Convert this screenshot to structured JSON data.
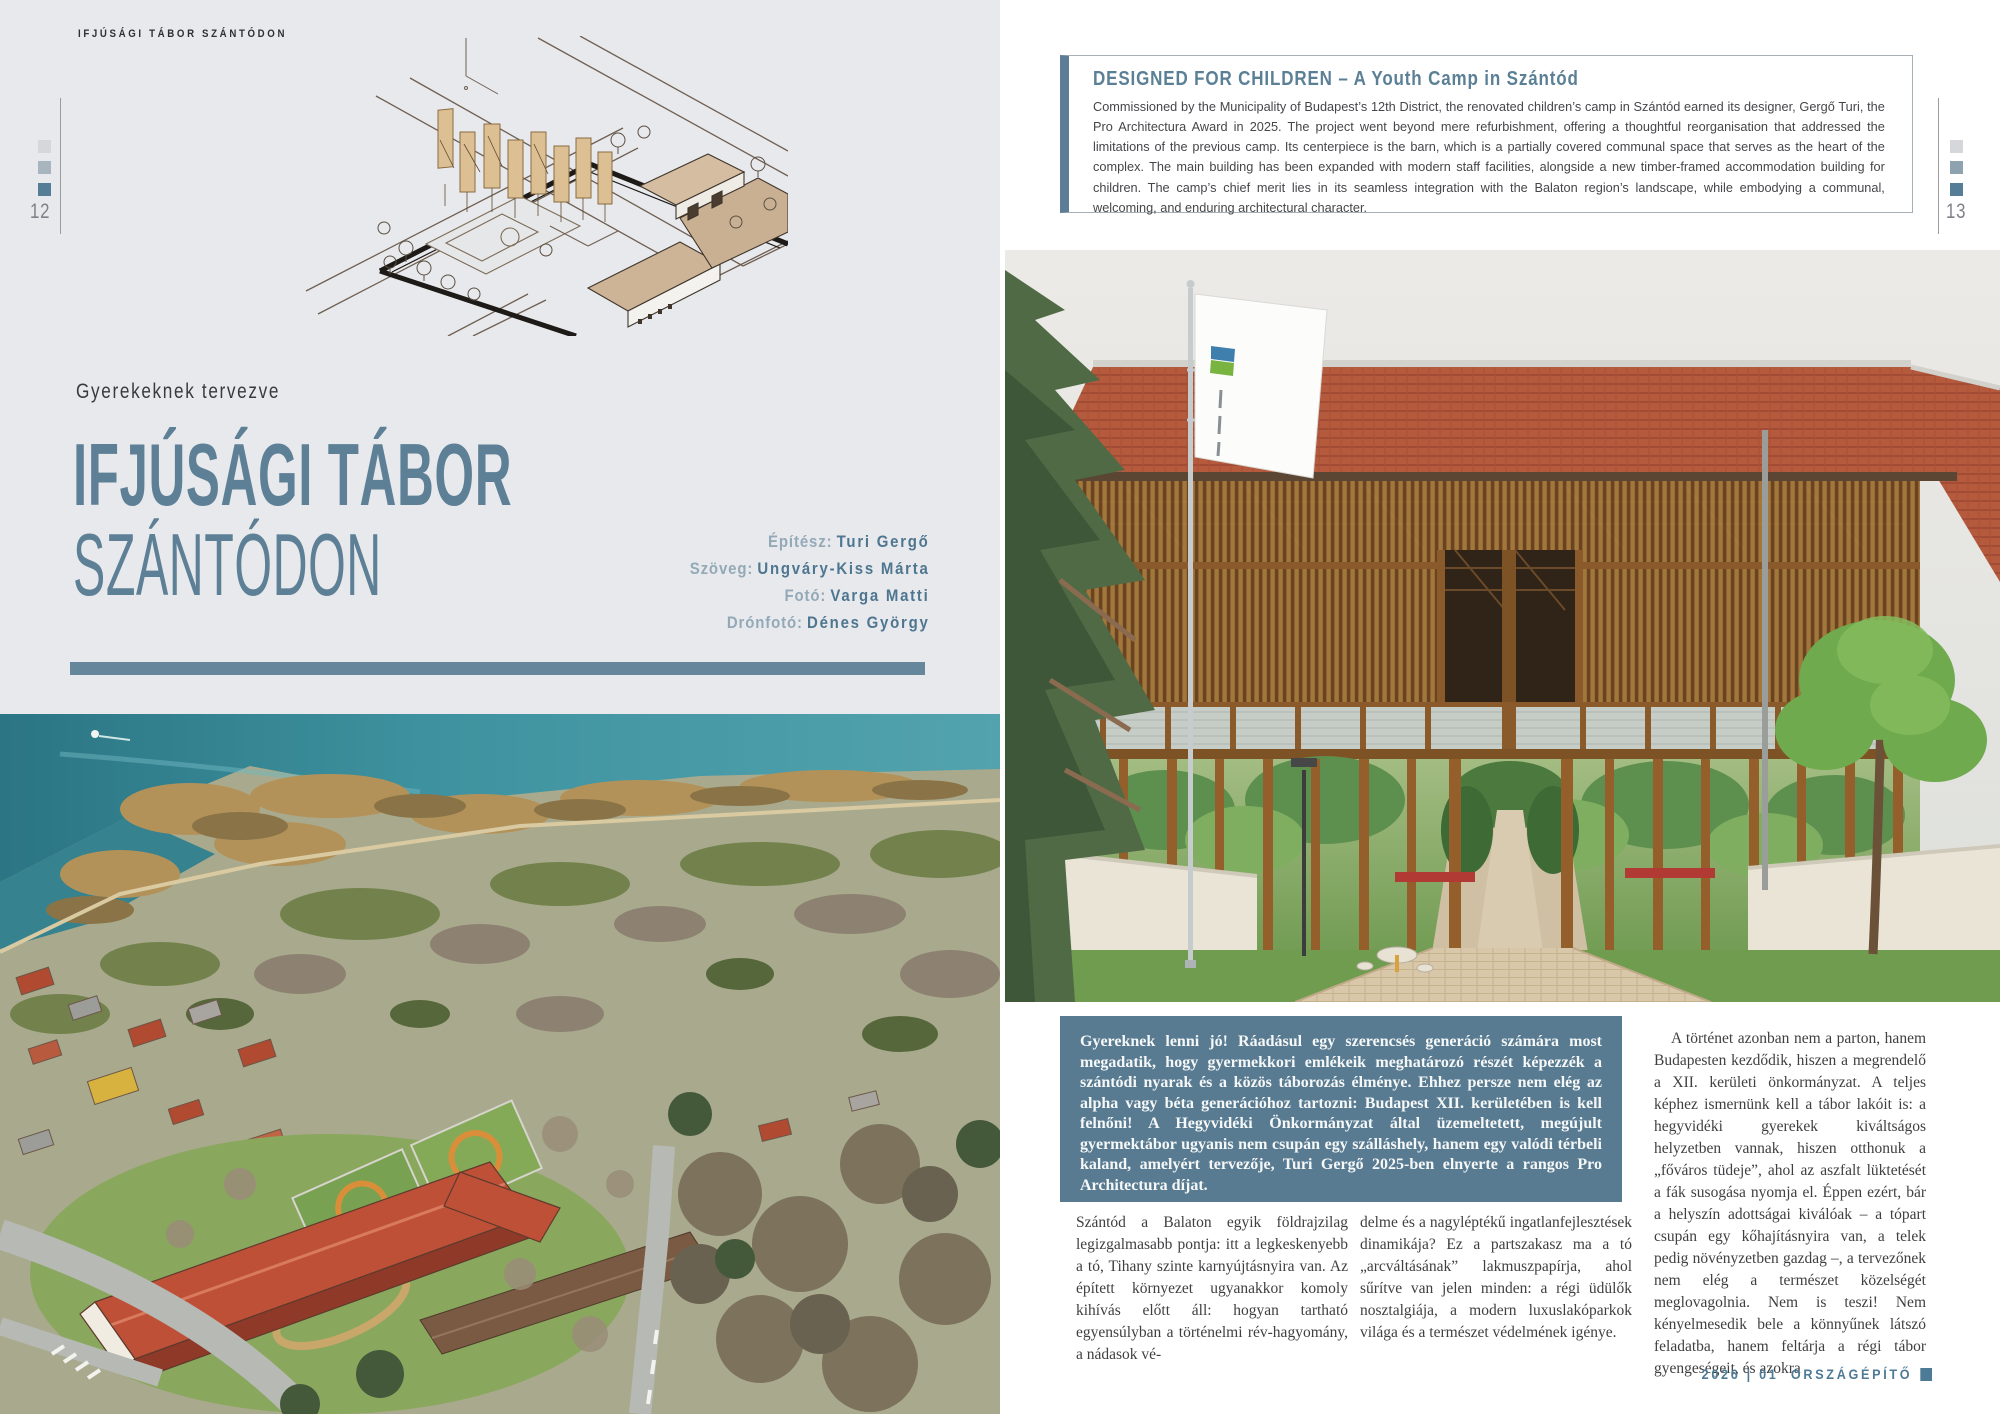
{
  "colors": {
    "accent_slate": "#5e8096",
    "lead_box_background": "#587b92",
    "left_page_background": "#e8e9ec",
    "footer_blue": "#4d7a96"
  },
  "page_left": {
    "running_header": "IFJÚSÁGI TÁBOR SZÁNTÓDON",
    "page_number": "12",
    "kicker": "Gyerekeknek tervezve",
    "title_line1": "IFJÚSÁGI TÁBOR",
    "title_line2": "SZÁNTÓDON",
    "credits": [
      {
        "label": "Építész:",
        "name": "Turi Gergő"
      },
      {
        "label": "Szöveg:",
        "name": "Ungváry-Kiss Márta"
      },
      {
        "label": "Fotó:",
        "name": "Varga Matti"
      },
      {
        "label": "Drónfotó:",
        "name": "Dénes György"
      }
    ]
  },
  "page_right": {
    "page_number": "13",
    "intro": {
      "title": "DESIGNED FOR CHILDREN – A Youth Camp in Szántód",
      "body": "Commissioned by the Municipality of Budapest’s 12th District, the renovated children’s camp in Szántód earned its designer, Gergő Turi, the Pro Architectura Award in 2025. The project went beyond mere refurbishment, offering a thoughtful reorganisation that addressed the limitations of the previous camp. Its centerpiece is the barn, which is a partially covered communal space that serves as the heart of the complex. The main building has been expanded with modern staff facilities, alongside a new timber-framed accommodation building for children. The camp’s chief merit lies in its seamless integration with the Balaton region’s landscape, while embodying a communal, welcoming, and enduring architectural character."
    },
    "lead": "Gyereknek lenni jó! Ráadásul egy szerencsés generáció számára most megadatik, hogy gyermekkori emlékeik meghatározó részét képezzék a szántódi nyarak és a közös táborozás élménye. Ehhez persze nem elég az alpha vagy béta generációhoz tartozni: Budapest XII. kerületében is kell felnőni! A Hegyvidéki Önkormányzat által üzemeltetett, megújult gyermektábor ugyanis nem csupán egy szálláshely, hanem egy valódi térbeli kaland, amelyért tervezője, Turi Gergő 2025-ben elnyerte a rangos Pro Architectura díjat.",
    "columns": {
      "col1": "Szántód a Balaton egyik földrajzilag legizgalmasabb pontja: itt a legkeskenyebb a tó, Tihany szinte karnyújtásnyira van. Az épített környezet ugyanakkor komoly kihívás előtt áll: hogyan tartható egyensúlyban a történelmi rév-hagyomány, a nádasok vé-",
      "col2": "delme és a nagyléptékű ingatlanfejlesztések dinamikája? Ez a partszakasz ma a tó „arcváltásának” lakmuszpapírja, ahol sűrítve van jelen minden: a régi üdülők nosztalgiája, a modern luxuslakóparkok világa és a természet védelmének igénye.",
      "col3": "A történet azonban nem a parton, hanem Budapesten kezdődik, hiszen a megrendelő a XII. kerületi önkormányzat. A teljes képhez ismernünk kell a tábor lakóit is: a hegyvidéki gyerekek kiváltságos helyzetben vannak, hiszen otthonuk a „főváros tüdeje”, ahol az aszfalt lüktetését a fák susogása nyomja el. Éppen ezért, bár a helyszín adottságai kiválóak – a tópart csupán egy kőhajításnyira van, a telek pedig növényzetben gazdag –, a tervezőnek nem elég a természet közelségét meglovagolnia. Nem is teszi! Nem kényelmesedik bele a könnyűnek látszó feladatba, hanem feltárja a régi tábor gyengeségeit, és azokra"
    },
    "footer": {
      "issue": "2026 | 01",
      "magazine": "ORSZÁGÉPÍTŐ"
    }
  }
}
